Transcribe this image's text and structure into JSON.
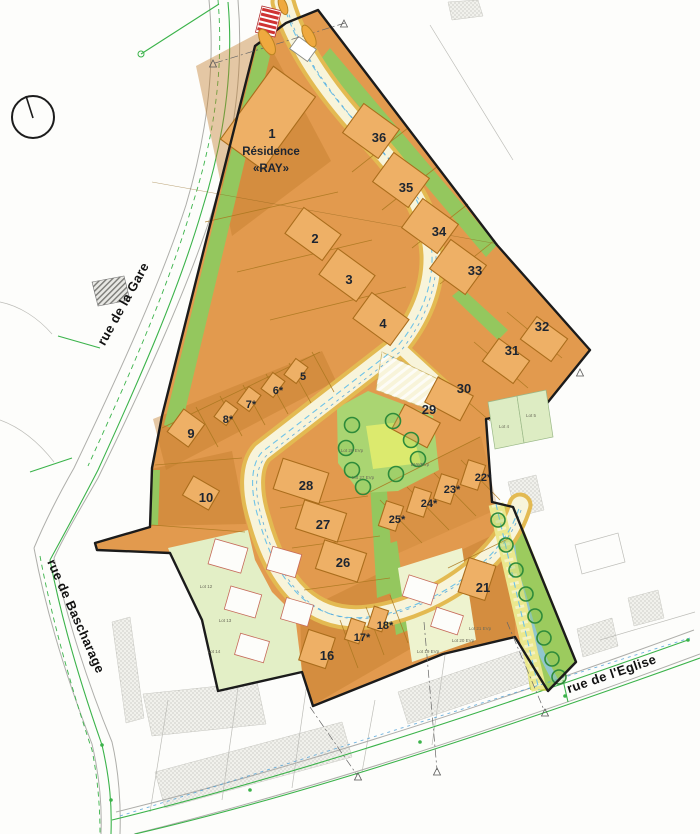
{
  "map": {
    "plan_type": "lotissement-site-plan",
    "compass": {
      "icon": "north-compass-icon"
    },
    "crossing": {
      "icon": "zebra-crossing-icon"
    },
    "residence": {
      "x": 271,
      "lines": [
        {
          "t": "Résidence",
          "y": 155
        },
        {
          "t": "«RAY»",
          "y": 172
        }
      ]
    },
    "streets": [
      {
        "label": "rue de la Gare",
        "x": 127,
        "y": 306,
        "rot": -61,
        "size": 13
      },
      {
        "label": "rue de Bascharage",
        "x": 72,
        "y": 618,
        "rot": 66,
        "size": 13
      },
      {
        "label": "rue de l'Eglise",
        "x": 613,
        "y": 678,
        "rot": -19,
        "size": 14
      }
    ],
    "lots": [
      {
        "n": "1",
        "x": 272,
        "y": 138
      },
      {
        "n": "2",
        "x": 315,
        "y": 243
      },
      {
        "n": "3",
        "x": 349,
        "y": 284
      },
      {
        "n": "4",
        "x": 383,
        "y": 328
      },
      {
        "n": "5",
        "x": 303,
        "y": 380,
        "small": true
      },
      {
        "n": "6*",
        "x": 278,
        "y": 394,
        "small": true
      },
      {
        "n": "7*",
        "x": 251,
        "y": 408,
        "small": true
      },
      {
        "n": "8*",
        "x": 228,
        "y": 423,
        "small": true
      },
      {
        "n": "9",
        "x": 191,
        "y": 438
      },
      {
        "n": "10",
        "x": 206,
        "y": 502
      },
      {
        "n": "16",
        "x": 327,
        "y": 660
      },
      {
        "n": "17*",
        "x": 362,
        "y": 641,
        "small": true
      },
      {
        "n": "18*",
        "x": 385,
        "y": 629,
        "small": true
      },
      {
        "n": "21",
        "x": 483,
        "y": 592
      },
      {
        "n": "22*",
        "x": 483,
        "y": 481,
        "small": true
      },
      {
        "n": "23*",
        "x": 452,
        "y": 493,
        "small": true
      },
      {
        "n": "24*",
        "x": 429,
        "y": 507,
        "small": true
      },
      {
        "n": "25*",
        "x": 397,
        "y": 523,
        "small": true
      },
      {
        "n": "26",
        "x": 343,
        "y": 567
      },
      {
        "n": "27",
        "x": 323,
        "y": 529
      },
      {
        "n": "28",
        "x": 306,
        "y": 490
      },
      {
        "n": "29",
        "x": 429,
        "y": 414
      },
      {
        "n": "30",
        "x": 464,
        "y": 393
      },
      {
        "n": "31",
        "x": 512,
        "y": 355
      },
      {
        "n": "32",
        "x": 542,
        "y": 331
      },
      {
        "n": "33",
        "x": 475,
        "y": 275
      },
      {
        "n": "34",
        "x": 439,
        "y": 236
      },
      {
        "n": "35",
        "x": 406,
        "y": 192
      },
      {
        "n": "36",
        "x": 379,
        "y": 142
      }
    ],
    "micro_labels": [
      {
        "t": "Lot 12",
        "x": 206,
        "y": 588
      },
      {
        "t": "Lot 13",
        "x": 225,
        "y": 622
      },
      {
        "t": "Lot 14",
        "x": 214,
        "y": 653
      },
      {
        "t": "Lot 19 EVp",
        "x": 428,
        "y": 653
      },
      {
        "t": "Lot 20 EVp",
        "x": 463,
        "y": 642
      },
      {
        "t": "Lot 21 EVp",
        "x": 480,
        "y": 630
      },
      {
        "t": "Lot 26 EVp",
        "x": 352,
        "y": 452
      },
      {
        "t": "Lot 27 EVp",
        "x": 363,
        "y": 479
      },
      {
        "t": "EVp/EVp",
        "x": 420,
        "y": 466
      },
      {
        "t": "Lot 4",
        "x": 504,
        "y": 428
      },
      {
        "t": "Lot 5",
        "x": 531,
        "y": 417
      }
    ],
    "colors": {
      "parcel_orange": "#e29a4e",
      "parcel_dark": "#c07c2c",
      "building_fill": "#eeb066",
      "building_stroke": "#aa6d1c",
      "boundary": "#1b1b1b",
      "road_fill": "#f8f4da",
      "road_casing": "#e3ba52",
      "verge_green": "#94c75e",
      "park_green": "#aad572",
      "park_patch": "#dcea6e",
      "pale_zone": "#e3efc6",
      "corridor_green": "#9ccb5e",
      "corridor_path": "#ebe88e",
      "stream_blue": "#8fc6e2",
      "tree_stroke": "#2e8b3a",
      "survey_green": "#3bb34a",
      "zebra_red": "#cf3333",
      "label_dark": "#1d2531",
      "utility_cyan": "#6ec3e8"
    }
  }
}
